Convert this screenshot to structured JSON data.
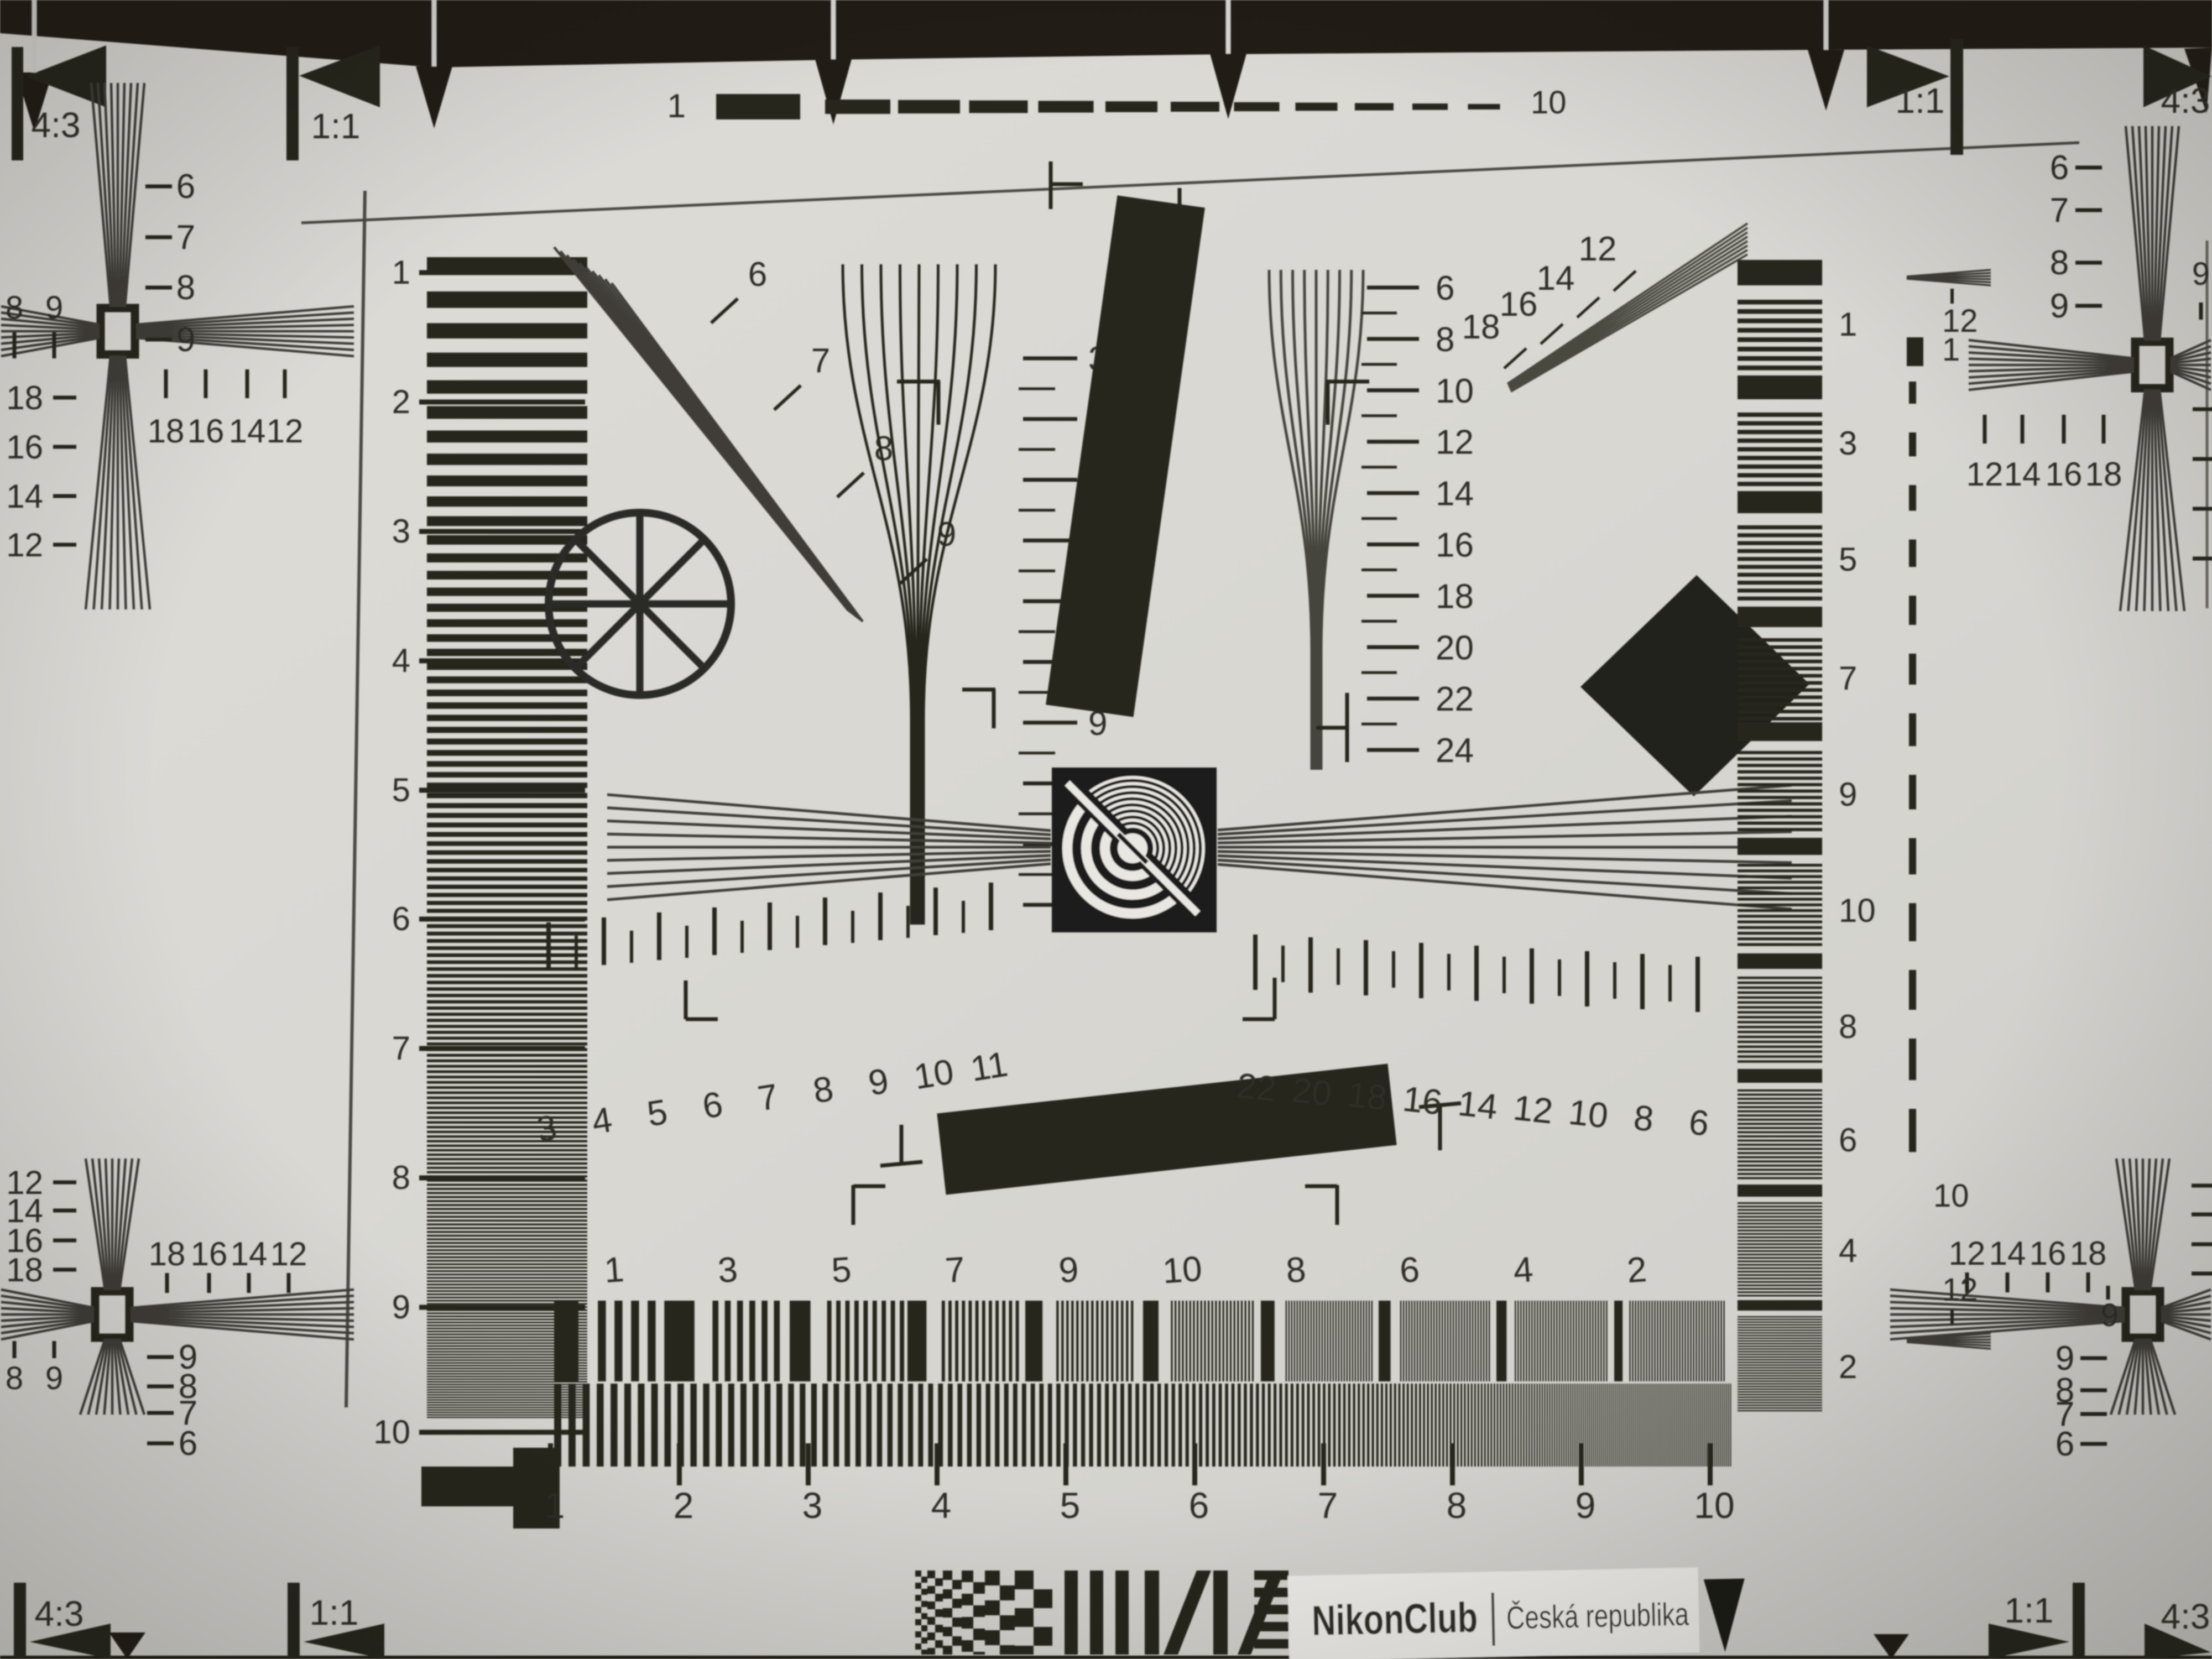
{
  "colors": {
    "paper": "#d9d8d3",
    "ink": "#26251f",
    "ink_soft": "#3f3e37",
    "background": "#201e18",
    "nikon_gold": "#cf9a36",
    "label_text": "#2c2630",
    "label_bg": "#edece8"
  },
  "aspect_markers": {
    "top_left": [
      "4:3",
      "1:1"
    ],
    "top_right": [
      "1:1",
      "4:3"
    ],
    "bottom_left": [
      "4:3",
      "1:1"
    ],
    "bottom_right": [
      "1:1",
      "4:3"
    ]
  },
  "top_dash_scale": {
    "start": "1",
    "end": "10"
  },
  "left_ruler": {
    "labels": [
      "1",
      "2",
      "3",
      "4",
      "5",
      "6",
      "7",
      "8",
      "9",
      "10"
    ]
  },
  "diagonal_wedge": {
    "labels": [
      "6",
      "7",
      "8",
      "9"
    ]
  },
  "center_wedge": {
    "labels": [
      "3",
      "4",
      "5",
      "6",
      "7",
      "8",
      "9",
      "10",
      "11",
      "12"
    ]
  },
  "right_wedge": {
    "labels": [
      "6",
      "8",
      "10",
      "12",
      "14",
      "16",
      "18",
      "20",
      "22",
      "24"
    ]
  },
  "tilted_wedge": {
    "labels": [
      "18",
      "16",
      "14",
      "12"
    ]
  },
  "h_scale_left": {
    "labels": [
      "3",
      "4",
      "5",
      "6",
      "7",
      "8",
      "9",
      "10",
      "11"
    ]
  },
  "h_scale_right": {
    "labels": [
      "22",
      "20",
      "18",
      "16",
      "14",
      "12",
      "10",
      "8",
      "6"
    ]
  },
  "burst_scale": {
    "labels": [
      "1",
      "3",
      "5",
      "7",
      "9",
      "10",
      "8",
      "6",
      "4",
      "2"
    ]
  },
  "bottom_ruler": {
    "labels": [
      "1",
      "2",
      "3",
      "4",
      "5",
      "6",
      "7",
      "8",
      "9",
      "10"
    ]
  },
  "bar_scale_right": {
    "labels": [
      "1",
      "3",
      "5",
      "7",
      "9",
      "10",
      "8",
      "6",
      "4",
      "2"
    ]
  },
  "dash_column": {
    "upper_wedge_label": "12",
    "block_label": "1",
    "end_label": "10",
    "lower_wedge_label": "12"
  },
  "cross_tl": {
    "fan_labels": [
      "6",
      "7",
      "8",
      "9"
    ],
    "pair_labels": [
      "8",
      "9"
    ],
    "side_labels": [
      "18",
      "16",
      "14",
      "12"
    ],
    "row_labels": [
      "18",
      "16",
      "14",
      "12"
    ]
  },
  "cross_tr": {
    "fan_labels": [
      "6",
      "7",
      "8",
      "9"
    ],
    "pair_labels": [
      "9"
    ],
    "row_labels": [
      "12",
      "14",
      "16",
      "18"
    ]
  },
  "cross_bl": {
    "fan_labels": [
      "9",
      "8",
      "7",
      "6"
    ],
    "pair_labels": [
      "8",
      "9"
    ],
    "side_labels": [
      "12",
      "14",
      "16",
      "18"
    ],
    "row_labels": [
      "18",
      "16",
      "14",
      "12"
    ]
  },
  "cross_br": {
    "fan_labels": [
      "9",
      "8",
      "7",
      "6"
    ],
    "pair_labels": [
      "9"
    ],
    "row_labels": [
      "12",
      "14",
      "16",
      "18"
    ]
  },
  "branding": {
    "club": "NikonClub",
    "region": "Česká republika"
  }
}
